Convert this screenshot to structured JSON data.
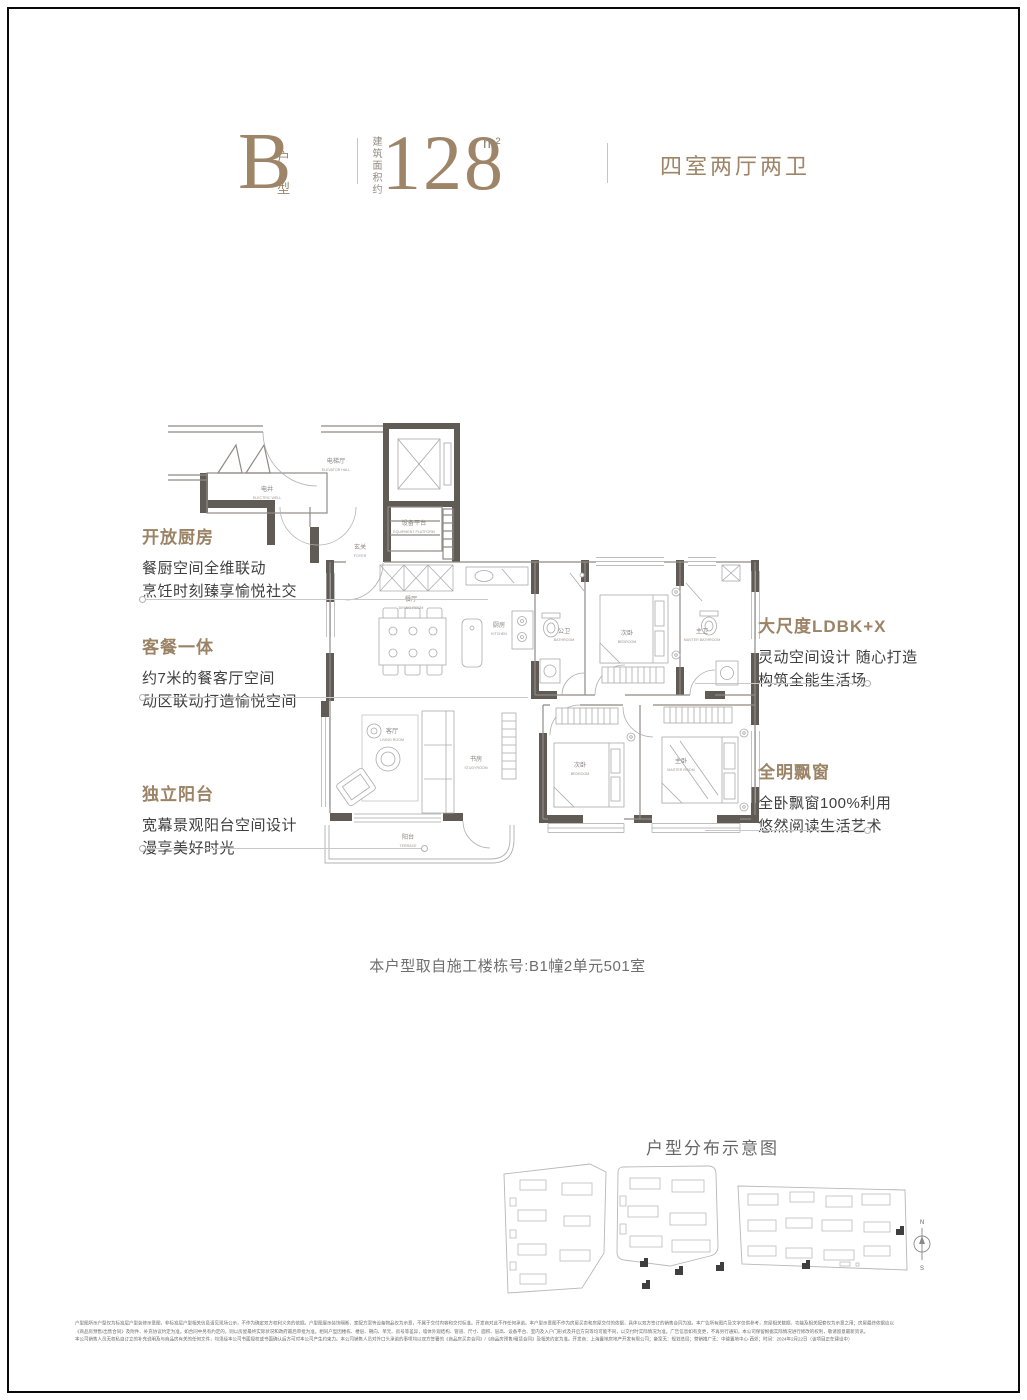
{
  "page": {
    "background": "#ffffff",
    "frame_color": "#0a0a0a"
  },
  "header": {
    "accent_color": "#9e8568",
    "type_letter": "B",
    "type_suffix": [
      "户",
      "型"
    ],
    "area_label": "建筑面积约",
    "area_value": "128",
    "area_unit": "m²",
    "rooms_summary": "四室两厅两卫"
  },
  "annotations": {
    "left": [
      {
        "title": "开放厨房",
        "lines": [
          "餐厨空间全维联动",
          "烹饪时刻臻享愉悦社交"
        ]
      },
      {
        "title": "客餐一体",
        "lines": [
          "约7米的餐客厅空间",
          "动区联动打造愉悦空间"
        ]
      },
      {
        "title": "独立阳台",
        "lines": [
          "宽幕景观阳台空间设计",
          "漫享美好时光"
        ]
      }
    ],
    "right": [
      {
        "title": "大尺度LDBK+X",
        "lines": [
          "灵动空间设计 随心打造",
          "构筑全能生活场"
        ]
      },
      {
        "title": "全明飘窗",
        "lines": [
          "全卧飘窗100%利用",
          "悠然阅读生活艺术"
        ]
      }
    ]
  },
  "floorplan": {
    "caption": "本户型取自施工楼栋号:B1幢2单元501室",
    "rooms": [
      {
        "cn": "电井",
        "en": "ELECTRIC WELL"
      },
      {
        "cn": "电梯厅",
        "en": "ELEVATOR HALL"
      },
      {
        "cn": "设备平台",
        "en": "EQUIPMENT PLATFORM"
      },
      {
        "cn": "玄关",
        "en": "FOYER"
      },
      {
        "cn": "餐厅",
        "en": "DINING ROOM"
      },
      {
        "cn": "厨房",
        "en": "KITCHEN"
      },
      {
        "cn": "公卫",
        "en": "BATHROOM"
      },
      {
        "cn": "次卧",
        "en": "BEDROOM"
      },
      {
        "cn": "主卫",
        "en": "MASTER BATHROOM"
      },
      {
        "cn": "客厅",
        "en": "LIVING ROOM"
      },
      {
        "cn": "书房",
        "en": "STUDYROOM"
      },
      {
        "cn": "次卧",
        "en": "BEDROOM"
      },
      {
        "cn": "主卧",
        "en": "MASTER ROOM"
      },
      {
        "cn": "阳台",
        "en": "TERRACE"
      }
    ]
  },
  "siteplan": {
    "title": "户型分布示意图",
    "compass": {
      "north": "N",
      "south": "S"
    }
  },
  "disclaimer": {
    "lines": [
      "户型图所示户型仅为标准层户型装修示意图，非标准层户型相关信息请见现场公示，不作为确定双方权利义务的依据。户型图展示装饰隔断、家配方案等设备物品仅为示意，不属于交付内容和交付标准。开发商对此不作任何承诺。本户型示意图不作为房屋买卖和房屋交付的依据，具体以双方签订的销售合同为准。本广告所有图片及文字仅供参考，房屋相关数据、功能及相关配套仅为示意之用；房屋最终依据应以",
      "《商品房预售/出售合同》及附件、补充协议约定为准。如合同中另有约定的，则以房屋最终实际状况和政府最后审批为准。相同户型因楼栋、楼层、朝向、单元、房号等差异，墙体外观结构、管道、尺寸、面积、层高、设备平台、室内及入户门形式及开启方向等均可能不同，以交付时实际情况为准。广告信息如有变更，不再另行通知，本公司保留根据实际情况进行修改的权利，敬请留意最新资讯。",
      "本公司销售人员无权私自订立的补充说明及与商品房有关的任何文件，均须经本公司书面授权或书面确认后方可对本公司产生约束力。本公司销售人员对外口头承诺的事项均以双方签署的《商品房买卖合同》/《商品房预售/租赁合同》及相关约定为准。开发商：上海置地房地产开发有限公司；备案无：规划总局；营销推广无：中骏置地中心·西郊；时间：2024年2月22日（该项目正在建设中）"
    ]
  }
}
